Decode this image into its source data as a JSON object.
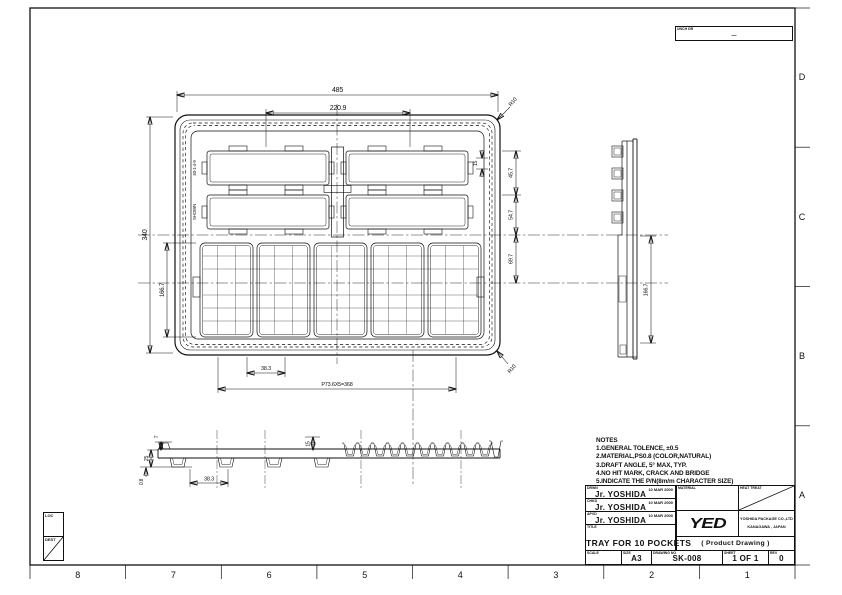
{
  "frame": {
    "bottom_zones": [
      "8",
      "7",
      "6",
      "5",
      "4",
      "3",
      "2",
      "1"
    ],
    "right_zones": [
      "D",
      "C",
      "B",
      "A"
    ]
  },
  "rev_box": {
    "label": "UNCH DR",
    "value": "—"
  },
  "loc_box": {
    "label": "LOC"
  },
  "dest_box": {
    "label": "DEST"
  },
  "notes": {
    "heading": "NOTES",
    "lines": [
      "1.GENERAL TOLENCE, ±0.5",
      "2.MATERIAL,PS0.8 (COLOR,NATURAL)",
      "3.DRAFT ANGLE, 5°  MAX, TYP.",
      "4.NO HIT MARK, CRACK AND BRIDGE",
      "5.INDICATE THE P/N(8m/m CHARACTER SIZE)"
    ]
  },
  "drawing": {
    "top_view": {
      "dim_overall_width": "485",
      "dim_inner_width": "220.9",
      "dim_overall_height": "340",
      "dim_pocket_zone_height": "166.7",
      "dim_right_1": "45.7",
      "dim_right_2": "54.7",
      "dim_right_3": "69.7",
      "dim_pitch": "P73.6X5=368",
      "dim_pocket_width": "38.3",
      "dim_step": "15",
      "radius_top": "R10",
      "radius_bottom": "R10",
      "label_part": "40-1-4-9",
      "label_shown": "SHOWN"
    },
    "side_view": {
      "dim_height": "166.7"
    },
    "front_view": {
      "dim_lip": "7",
      "dim_depth": "25",
      "dim_thickness": "0.8",
      "dim_pocket_width": "38.3",
      "dim_pocket_height": "15"
    }
  },
  "title_block": {
    "approvals": [
      {
        "role": "DRWN",
        "date": "10 MAR 2000",
        "name": "Jr. YOSHIDA"
      },
      {
        "role": "CHKD",
        "date": "10 MAR 2000",
        "name": "Jr. YOSHIDA"
      },
      {
        "role": "APVD",
        "date": "10 MAR 2000",
        "name": "Jr. YOSHIDA"
      }
    ],
    "title_label": "TITLE",
    "title": "TRAY FOR 10 POCKETS",
    "material_label": "MATERIAL",
    "heat_treat_label": "HEAT TREAT",
    "logo": "YED",
    "company_name": "YOSHIDA PACKAGE CO.,LTD",
    "company_location": "KANAGAWA , JAPAN",
    "product_type": "( Product Drawing )",
    "scale_label": "SCALE",
    "size_label": "SIZE",
    "size": "A3",
    "drawing_no_label": "DRAWING NO",
    "drawing_no": "SK-008",
    "sheet_label": "SHEET",
    "sheet": "1 OF 1",
    "rev_label": "REV",
    "rev": "0"
  }
}
